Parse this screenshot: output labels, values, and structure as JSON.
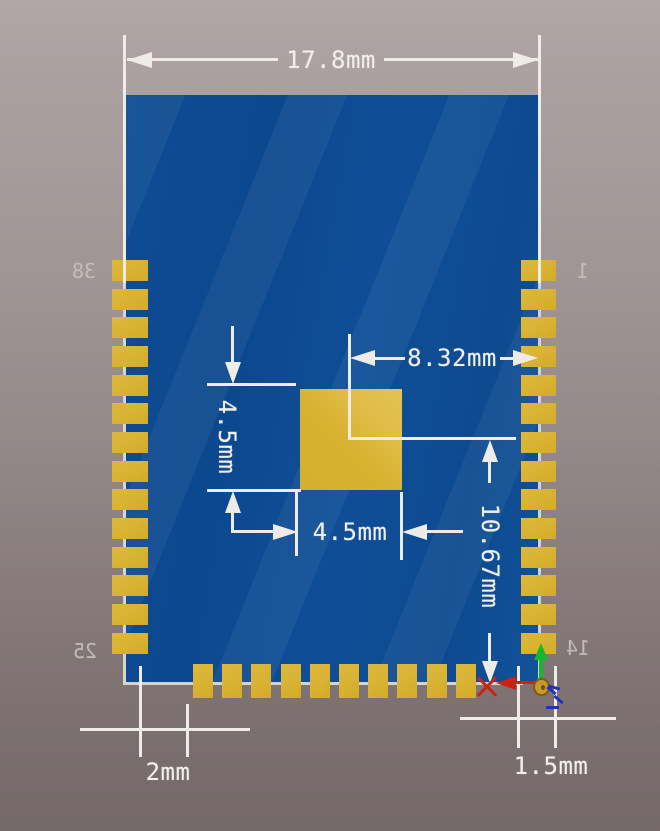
{
  "title": "PCB module footprint dimension drawing",
  "dimensions": {
    "board_width": "17.8mm",
    "pad_center_x": "8.32mm",
    "thermal_pad_height": "4.5mm",
    "thermal_pad_width": "4.5mm",
    "pad_center_y": "10.67mm",
    "bottom_left_offset": "2mm",
    "bottom_right_pad": "1.5mm"
  },
  "pins": {
    "top_left": "38",
    "top_right": "1",
    "bottom_left": "25",
    "bottom_right": "14"
  },
  "pads": {
    "left_count": 14,
    "right_count": 14,
    "bottom_count": 10
  },
  "colors": {
    "board_blue": "#0d4a91",
    "pad_gold": "#d9b233",
    "dimension_white": "#efece8",
    "background_top": "#b1a7a6",
    "background_bottom": "#746968",
    "x_axis_red": "#cc2211",
    "y_axis_green": "#16b829",
    "z_axis_blue": "#2233bb"
  },
  "icons": {
    "x_axis": "x-axis-arrow",
    "y_axis": "y-axis-arrow",
    "z_axis": "z-axis-dashed-arrow",
    "origin": "origin-pad-marker"
  }
}
